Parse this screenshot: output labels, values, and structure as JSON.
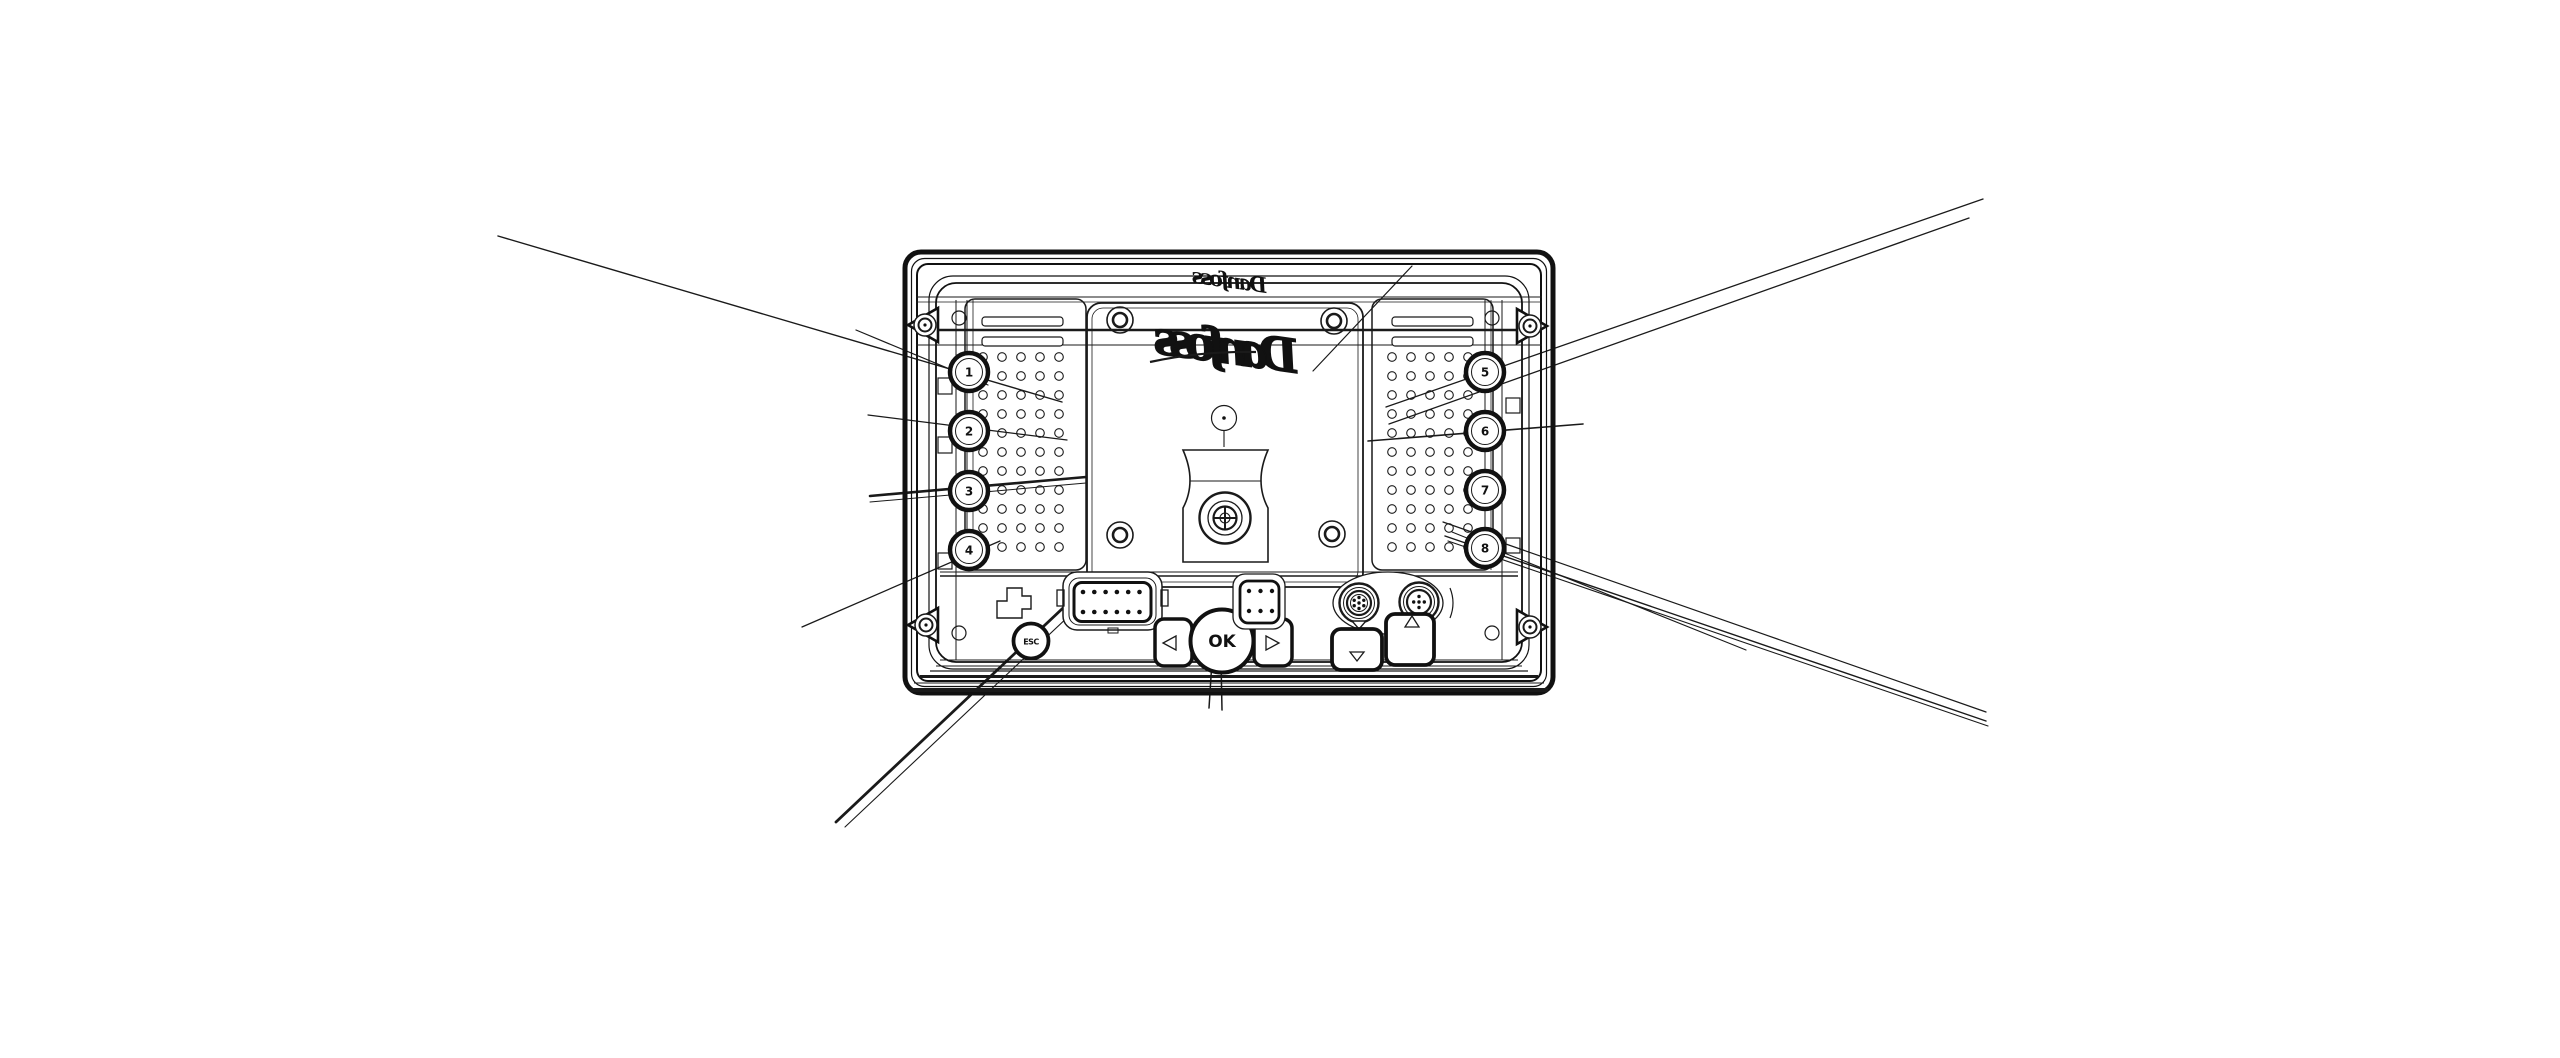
{
  "diagram": {
    "type": "technical-line-drawing",
    "subject": "device-rear-view-with-callout-leader-lines",
    "colors": {
      "background": "#ffffff",
      "line": "#1a1a1a"
    },
    "brand": {
      "logo_large": "Danfoss",
      "logo_top": "Danfoss"
    },
    "buttons": {
      "left": [
        "1",
        "2",
        "3",
        "4"
      ],
      "right": [
        "5",
        "6",
        "7",
        "8"
      ],
      "esc": "ESC",
      "ok": "OK",
      "nav_glyphs": {
        "left": "◁",
        "right": "▷",
        "down": "▽",
        "up": "△"
      }
    },
    "connectors": {
      "main_connector_pins": 12,
      "aux_connector_pins": 6,
      "round_connector_left_pins": 7,
      "round_connector_right_pins": 5
    },
    "fasteners": {
      "corner_screws": 4,
      "panel_screw_holes": 4
    }
  }
}
